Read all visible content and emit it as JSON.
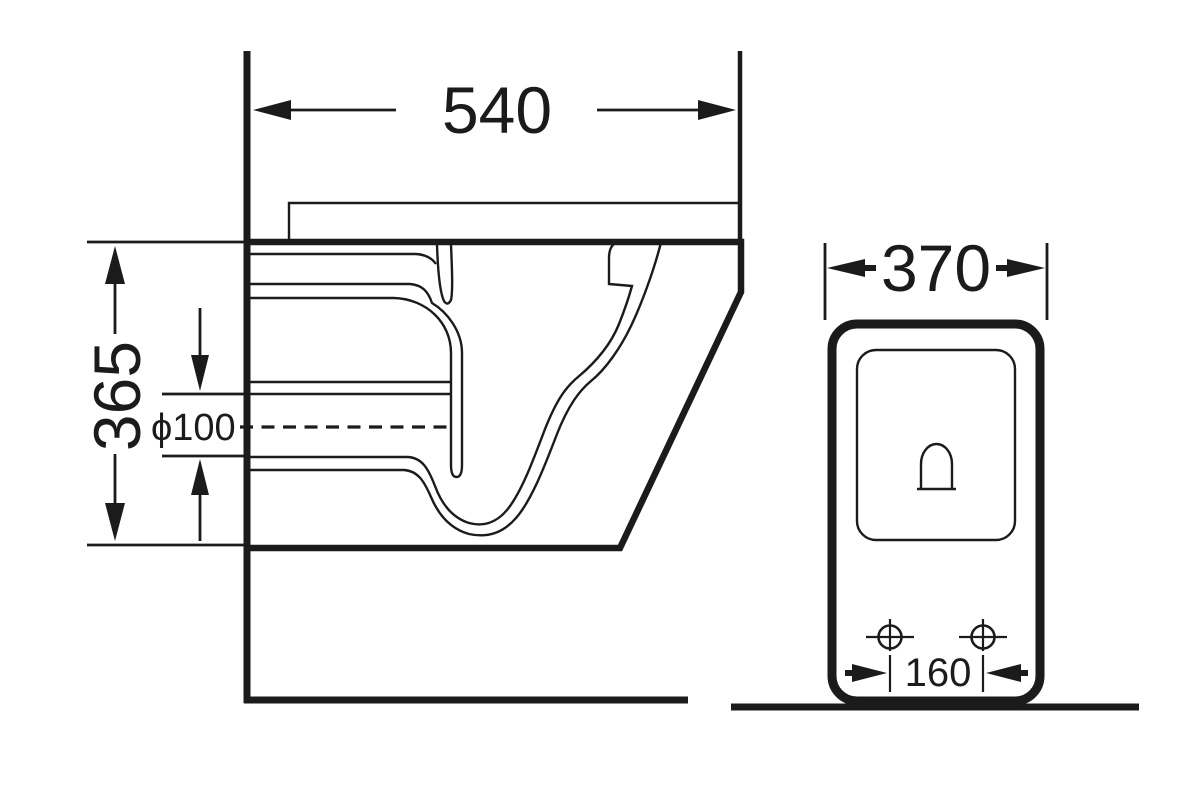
{
  "page": {
    "background": "#ffffff",
    "line_color": "#1b1b1b"
  },
  "side_view": {
    "dim_width": "540",
    "dim_height": "365",
    "dim_outlet": "ϕ100"
  },
  "rear_view": {
    "dim_width": "370",
    "dim_hole_spacing": "160"
  }
}
